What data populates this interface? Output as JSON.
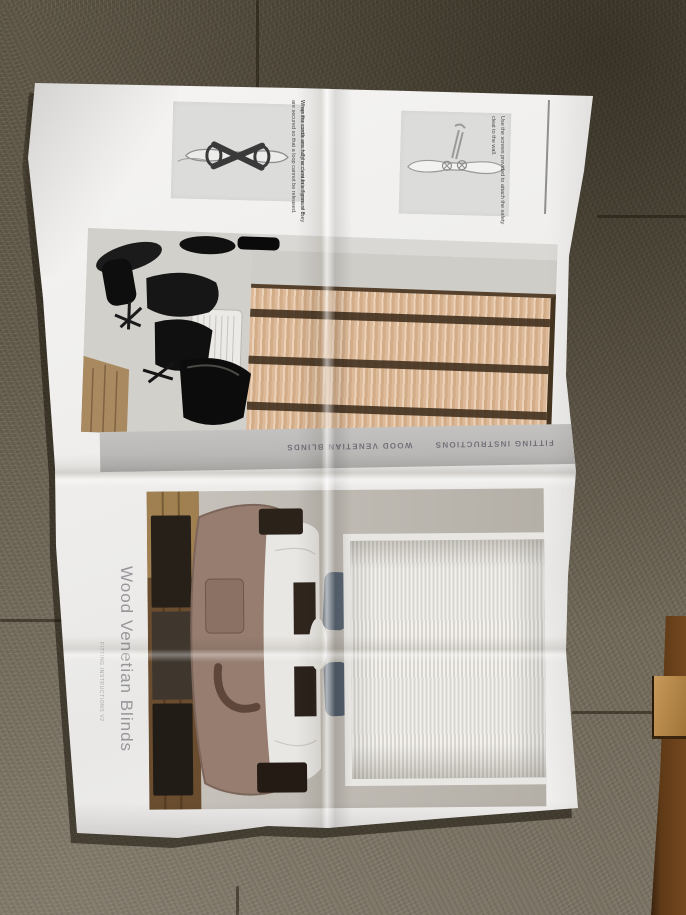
{
  "instructions": {
    "step1_text": "Wrap the cords around the cleat in a figure of 8.",
    "step2_text": "When the cords are fully accumulated ensure they are secured so that a loop cannot be released.",
    "step3_text": "Use the screws provided to attach the safety cleat to the wall."
  },
  "strip": {
    "fitting": "FITTING INSTRUCTIONS",
    "product": "WOOD VENETIAN BLINDS"
  },
  "cover": {
    "title": "Wood Venetian Blinds",
    "edition": "FITTING INSTRUCTIONS V2"
  },
  "colors": {
    "carpet": "#675f50",
    "wood_furniture": "#5f3a17",
    "paper": "#f2f1ef",
    "wood_slat_tan": "#dcb998",
    "strip_grey": "#bcbbb9",
    "title_grey": "#97969a",
    "chair_black": "#141414",
    "bed_taupe": "#967d70",
    "pillow_slate": "#5b6673"
  }
}
